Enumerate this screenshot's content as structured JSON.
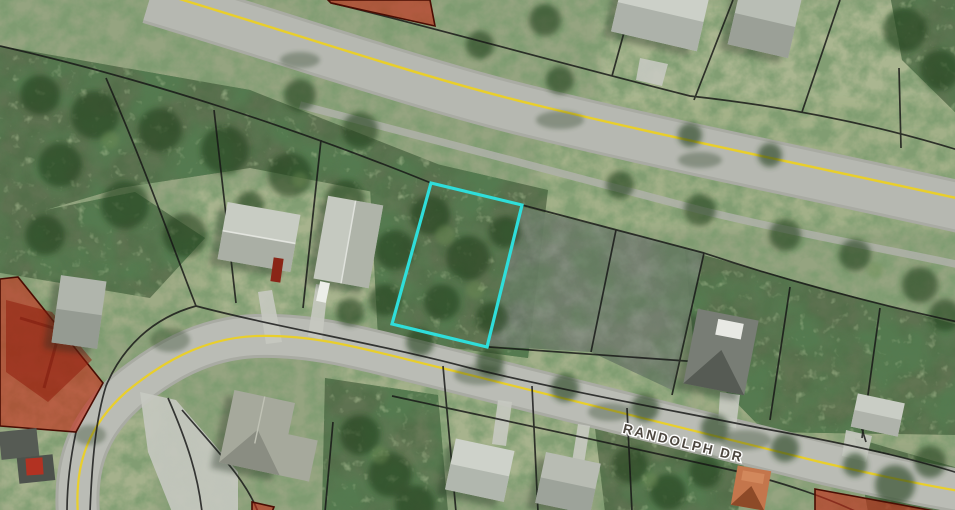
{
  "map": {
    "street_label": "RANDOLPH DR",
    "colors": {
      "selected_parcel_outline": "#2fdeda",
      "flagged_parcel_fill": "#c22d18",
      "flagged_parcel_border": "#4a0d03",
      "parcel_boundary": "#151515",
      "road_centerline": "#e9cf2b"
    }
  }
}
